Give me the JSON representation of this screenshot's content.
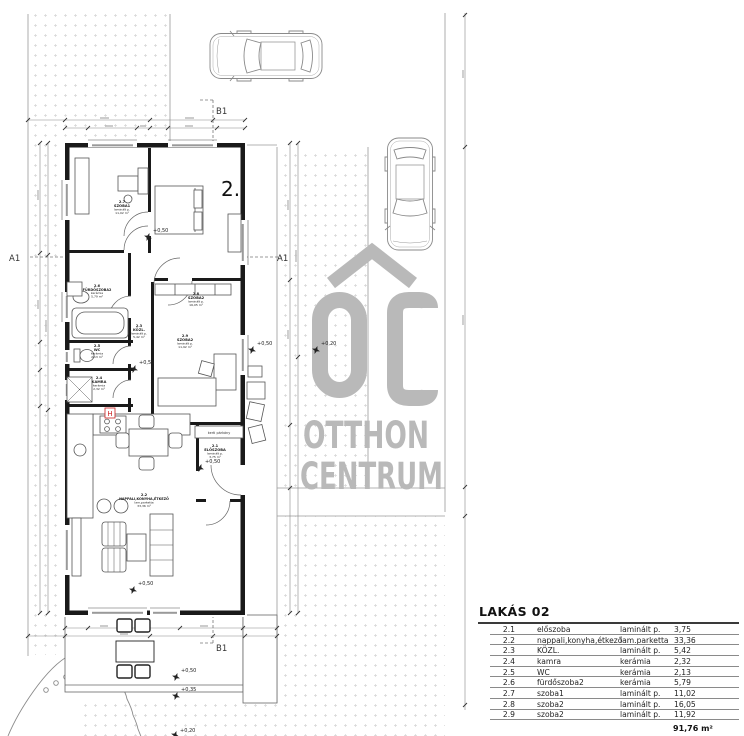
{
  "plan": {
    "unit_number": "2.",
    "section_a1": "A1",
    "section_b1": "B1",
    "note_kerti": "kerti párkány",
    "fridge_mark": "H",
    "levels": {
      "l50": "+0,50",
      "l35": "+0,35",
      "l20": "+0,20"
    },
    "rooms": {
      "r21": {
        "num": "2.1",
        "name": "ELŐSZOBA",
        "material": "laminált p.",
        "area": "3,75 m²"
      },
      "r22": {
        "num": "2.2",
        "name": "NAPPALI,KONYHA,ÉTKEZŐ",
        "material": "lam.parketta",
        "area": "33,36 m²"
      },
      "r23": {
        "num": "2.3",
        "name": "KÖZL.",
        "material": "laminált p.",
        "area": "5,42 m²"
      },
      "r24": {
        "num": "2.4",
        "name": "KAMRA",
        "material": "kerámia",
        "area": "2,32 m²"
      },
      "r25": {
        "num": "2.5",
        "name": "WC",
        "material": "kerámia",
        "area": "2,13 m²"
      },
      "r26": {
        "num": "2.6",
        "name": "FÜRDŐSZOBA2",
        "material": "kerámia",
        "area": "5,79 m²"
      },
      "r27": {
        "num": "2.7",
        "name": "SZOBA1",
        "material": "laminált p.",
        "area": "11,02 m²"
      },
      "r28": {
        "num": "2.8",
        "name": "SZOBA2",
        "material": "laminált p.",
        "area": "16,05 m²"
      },
      "r29": {
        "num": "2.9",
        "name": "SZOBA2",
        "material": "laminált p.",
        "area": "11,92 m²"
      }
    }
  },
  "watermark": {
    "word1": "OTTHON",
    "word2": "CENTRUM"
  },
  "colors": {
    "watermark_gray": "#b9b9b9",
    "accent_red": "#cc2222",
    "stipple": "#d6d6d6"
  },
  "table": {
    "title": "LAKÁS 02",
    "rows": [
      {
        "num": "2.1",
        "name": "előszoba",
        "material": "laminált p.",
        "area": "3,75"
      },
      {
        "num": "2.2",
        "name": "nappali,konyha,étkező",
        "material": "lam.parketta",
        "area": "33,36"
      },
      {
        "num": "2.3",
        "name": "KÖZL.",
        "material": "laminált p.",
        "area": "5,42"
      },
      {
        "num": "2.4",
        "name": "kamra",
        "material": "kerámia",
        "area": "2,32"
      },
      {
        "num": "2.5",
        "name": "WC",
        "material": "kerámia",
        "area": "2,13"
      },
      {
        "num": "2.6",
        "name": "fürdőszoba2",
        "material": "kerámia",
        "area": "5,79"
      },
      {
        "num": "2.7",
        "name": "szoba1",
        "material": "laminált p.",
        "area": "11,02"
      },
      {
        "num": "2.8",
        "name": "szoba2",
        "material": "laminált p.",
        "area": "16,05"
      },
      {
        "num": "2.9",
        "name": "szoba2",
        "material": "laminált p.",
        "area": "11,92"
      }
    ],
    "total": "91,76 m²"
  }
}
